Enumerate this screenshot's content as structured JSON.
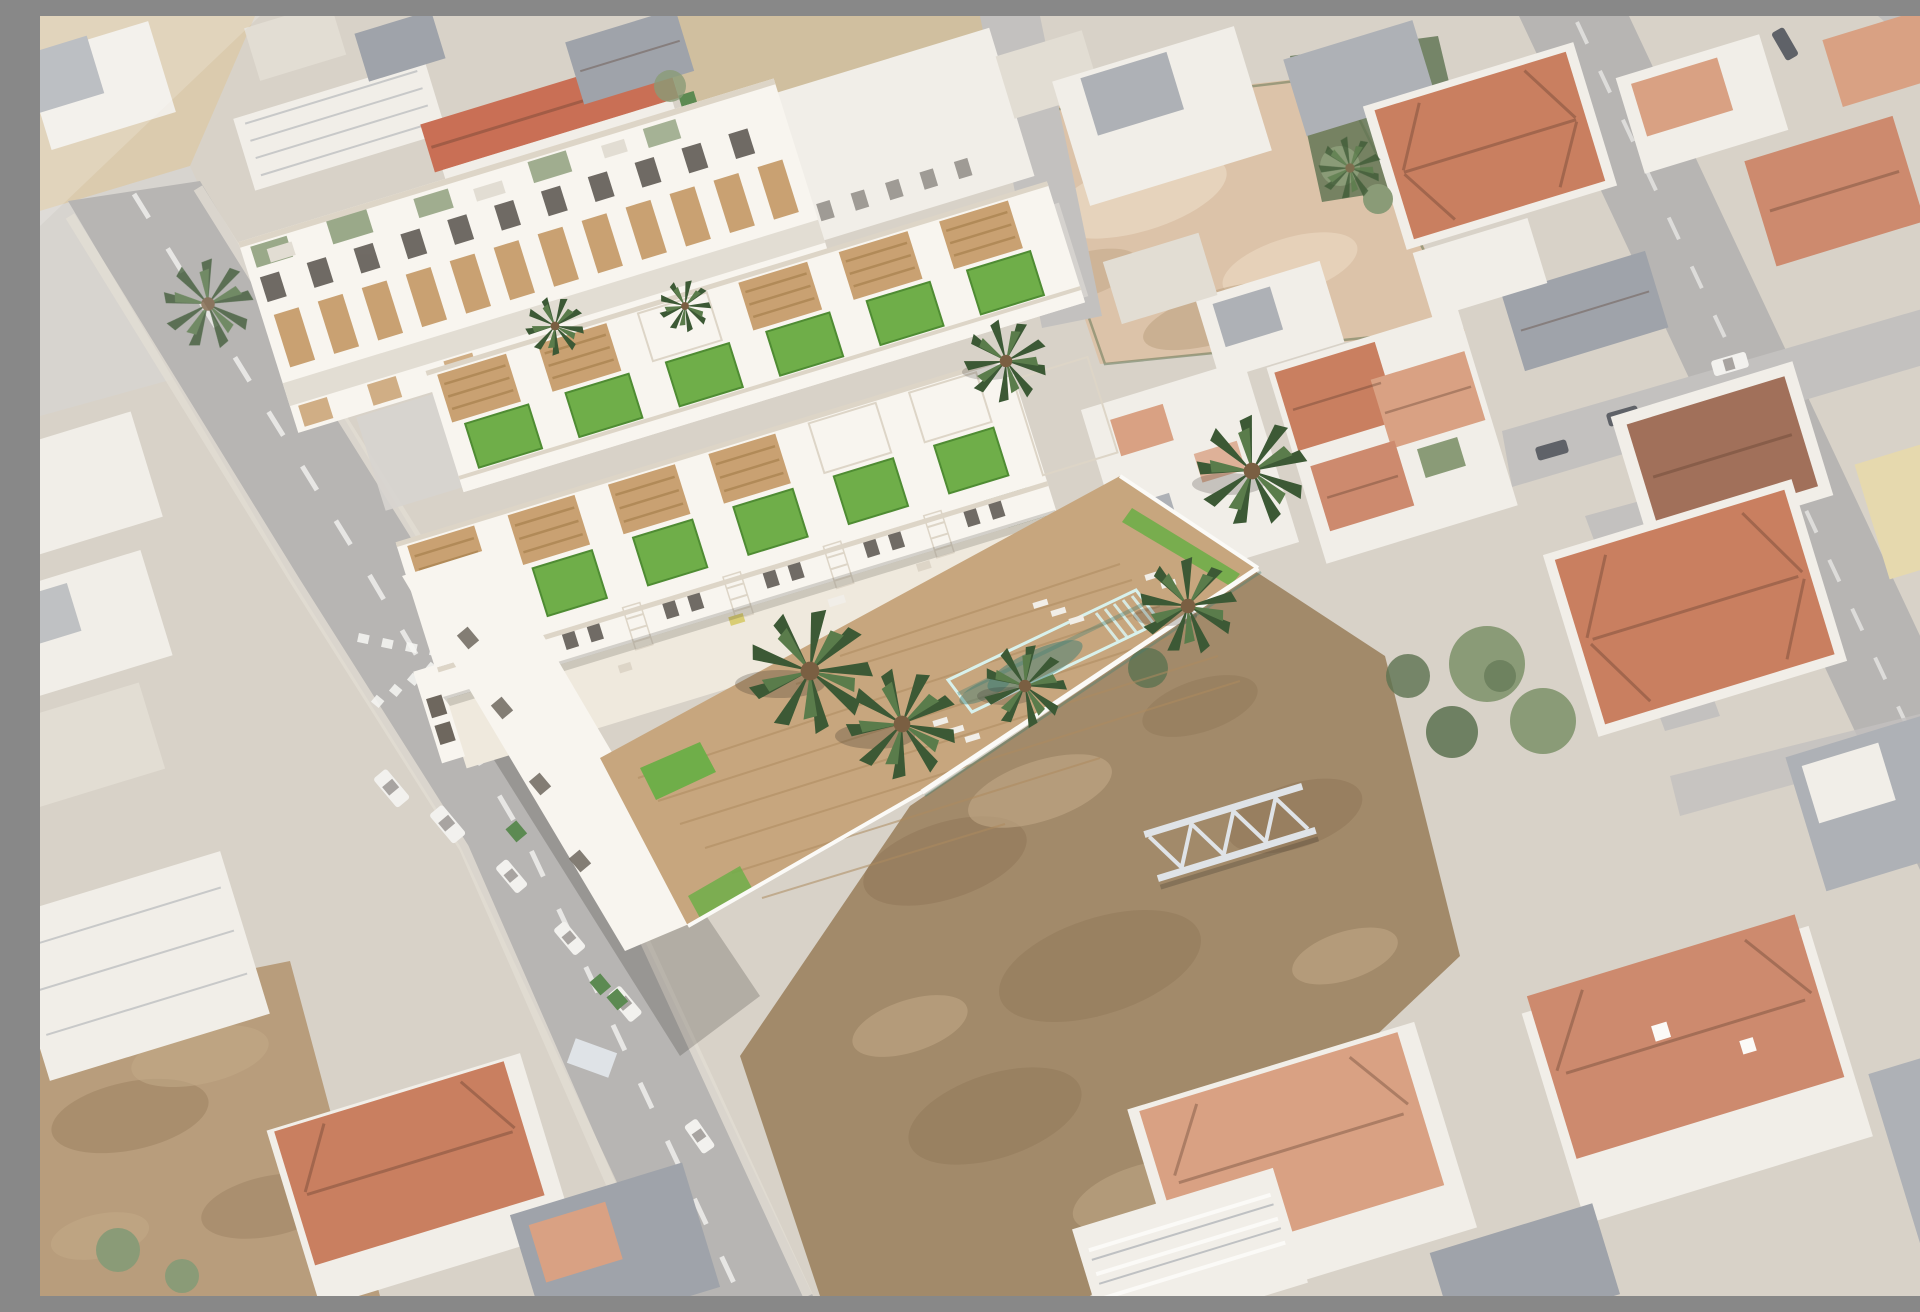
{
  "scene": {
    "type": "aerial-photo-with-architectural-render",
    "description": "Aerial photograph of a Mediterranean town with a superimposed 3D render of a new two-row townhouse development: white facades with timber-slat panels and pergolas, private rooftop lawns, external staircases, a communal rectangular turquoise pool on a timber deck with palm trees and sun loungers. The surrounding photo shows an asphalt street with dashed markings and parked vans on the left, vacant dirt lots in the centre and top, and dense existing housing with terracotta and grey roofs on the right. The photo areas appear washed out while the render is crisp.",
    "visible_text": []
  },
  "inventory": {
    "development": {
      "rows": 2,
      "townhouses_per_row": 6,
      "rooftop_lawns": 12,
      "timber_pergolas": 9,
      "external_staircases": 5,
      "pools": 1,
      "render_palm_trees": 8,
      "sun_loungers": 8,
      "garage_doors": 6
    },
    "surroundings": {
      "main_streets": 2,
      "minor_lanes": 3,
      "give_way_dashes": 9,
      "parked_vehicles": 13,
      "green_dumpsters": 5,
      "vacant_dirt_lots": 3,
      "steel_truss_structures": 1,
      "street_palm_trees": 2,
      "existing_apartment_blocks": 1
    }
  },
  "palette": {
    "base": "#d8d2c8",
    "asphalt": "#b7b5b3",
    "asphalt2": "#c3c1bf",
    "marking": "#f7f7f4",
    "sidewalk": "#d7d4cf",
    "sand": "#dbcbae",
    "sand2": "#d0bf9f",
    "dirtPink": "#dcc3a9",
    "dirtPinkLight": "#e9d7c1",
    "dirtDark": "#a28a6a",
    "dirtShadow": "#8b7254",
    "dirtHighlight": "#c2a987",
    "dirtBL": "#b89d7c",
    "photoWhite": "#f1eee8",
    "photoWall": "#e2ddd3",
    "roofTerra1": "#c97f60",
    "roofTerra2": "#cd8a6e",
    "roofTerra3": "#d9a183",
    "roofRed": "#c96f55",
    "roofBrown": "#a1705a",
    "roofGrey1": "#aeb1b6",
    "roofGrey2": "#9fa3aa",
    "wallYellow": "#e6d9ae",
    "treePhoto": "#8a9b77",
    "treeDark": "#5c7250",
    "renderWhite": "#f8f5ef",
    "renderShade": "#ddd5c7",
    "renderTerrace": "#efe9dd",
    "pergola": "#c9a172",
    "pergolaLine": "#b18a58",
    "lawn": "#6fae49",
    "lawnEdge": "#4f8c33",
    "poolWater": "#8fd8d0",
    "poolLight": "#d8f1ec",
    "poolShadow": "#3f7d74",
    "deck": "#c7a67e",
    "deckLine": "#ad8a5f",
    "trunk": "#7a5f42",
    "palmDark": "#3c5935",
    "palmLight": "#5a7c4b",
    "windowDark": "#4e4842",
    "vehicleWhite": "#f2f1ee",
    "vehicleDark": "#5f6268",
    "dumpster": "#5c8a52",
    "truss": "#dfe3e7",
    "wallWhite": "#fbfaf7",
    "garageDark": "#6e675e",
    "furnYellow": "#d9cd74",
    "shadow": "#2f2a24"
  }
}
